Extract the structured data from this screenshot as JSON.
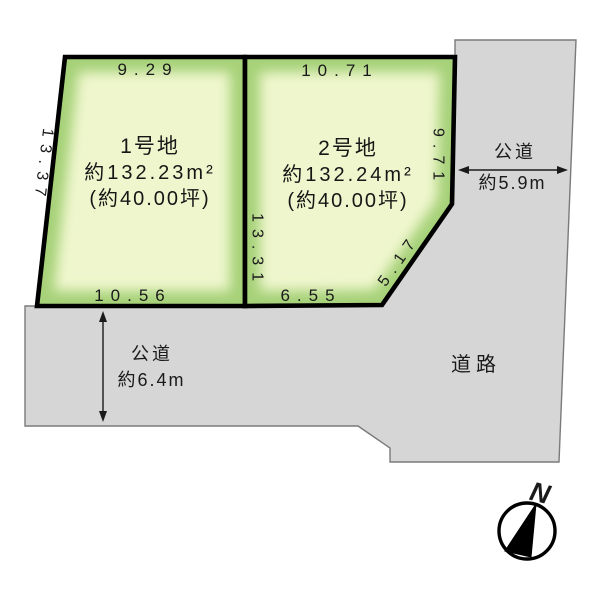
{
  "lots": [
    {
      "name": "1号地",
      "area": "約132.23m²",
      "tsubo": "(約40.00坪)",
      "dim_top": "9.29",
      "dim_left": "13.37",
      "dim_bottom": "10.56"
    },
    {
      "name": "2号地",
      "area": "約132.24m²",
      "tsubo": "(約40.00坪)",
      "dim_top": "10.71",
      "dim_left": "13.31",
      "dim_right": "9.71",
      "dim_bottom": "6.55",
      "dim_corner": "5.17"
    }
  ],
  "roads": {
    "right": {
      "name": "公道",
      "width": "約5.9m"
    },
    "bottom": {
      "name": "公道",
      "width": "約6.4m"
    },
    "far": {
      "name": "道路"
    }
  },
  "compass": {
    "north_label": "N"
  },
  "colors": {
    "lot_fill": "#eff6cd",
    "lot_edge_glow": "#a6d178",
    "lot_border": "#000000",
    "road_fill": "#d6d6d6",
    "road_border": "#7a7a7a",
    "text": "#1a1a1a"
  }
}
